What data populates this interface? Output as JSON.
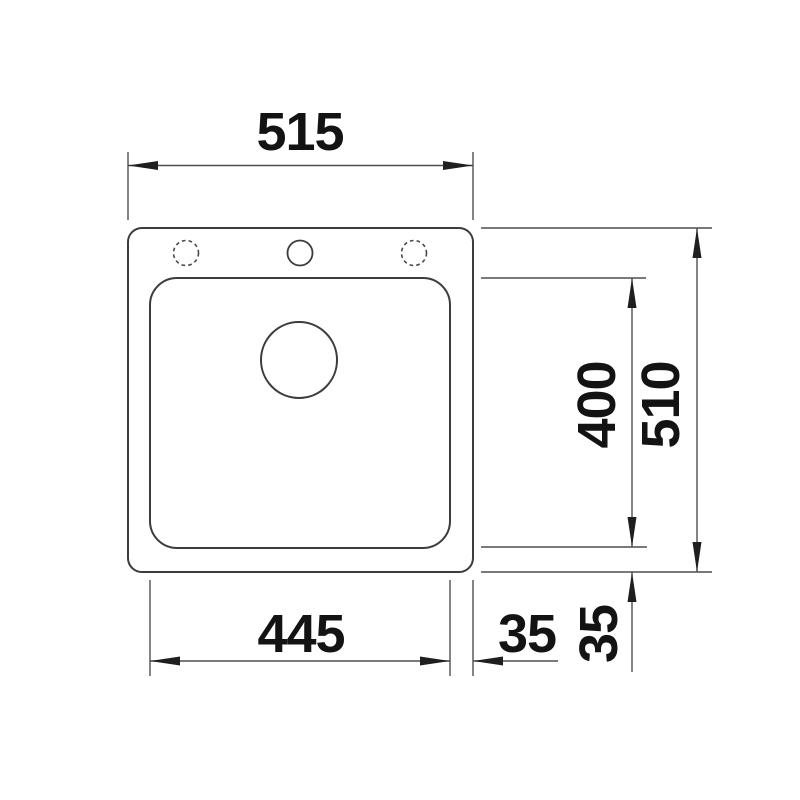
{
  "drawing": {
    "subject": "sink-top-view-dimension-drawing",
    "line_color": "#3c3c3c",
    "dimension_line_color": "#4f4f4f",
    "text_color": "#131313",
    "background_color": "#ffffff",
    "dimensions": {
      "overall_width": "515",
      "overall_depth": "510",
      "bowl_width": "445",
      "bowl_depth": "400",
      "offset_horizontal": "35",
      "offset_vertical": "35"
    }
  }
}
